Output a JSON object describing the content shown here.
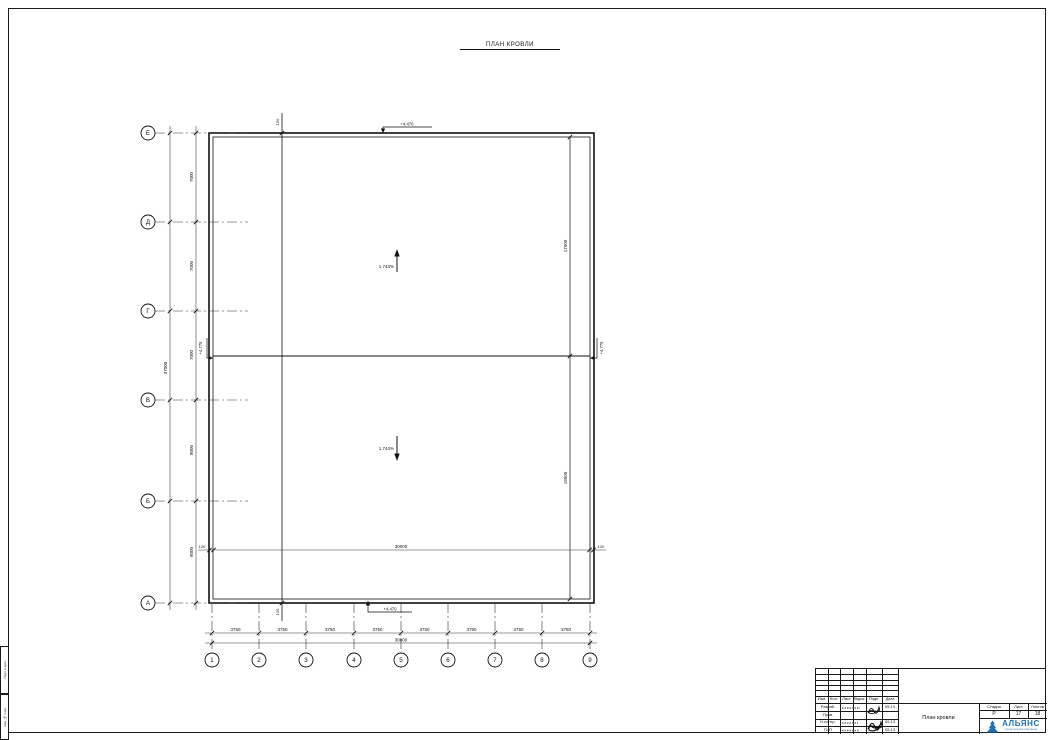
{
  "sheet": {
    "title": "ПЛАН КРОВЛИ"
  },
  "plan": {
    "slopes": {
      "upper": "1.743%",
      "lower": "1.744%"
    },
    "elevations": {
      "top": "+4.470",
      "bottom": "+4.470",
      "ridge_left": "+4.775",
      "ridge_right": "+4.775"
    },
    "axes_rows": {
      "labels": [
        "Е",
        "Д",
        "Г",
        "В",
        "Б",
        "А"
      ],
      "dims": [
        "7000",
        "7000",
        "7000",
        "8000",
        "8000"
      ],
      "total": "37000"
    },
    "axes_cols": {
      "labels": [
        "1",
        "2",
        "3",
        "4",
        "5",
        "6",
        "7",
        "8",
        "9"
      ],
      "dims": [
        "3750",
        "3750",
        "3750",
        "3750",
        "3750",
        "3750",
        "3750",
        "3750"
      ],
      "total": "30000"
    },
    "right_dims": {
      "upper": "17500",
      "lower": "19500"
    },
    "parapet_dims": {
      "top": "120",
      "bottom": "120",
      "inner_left": "120",
      "inner_total": "30000",
      "inner_right": "120"
    }
  },
  "titleblock": {
    "change_header": [
      "Изм.",
      "Кол.",
      "Лист",
      "№док.",
      "Подп.",
      "Дата"
    ],
    "staff": [
      {
        "role": "Разраб.",
        "date": "05.13"
      },
      {
        "role": "Пров.",
        "date": "05.13"
      },
      {
        "role": "Н.контр.",
        "date": "05.13"
      },
      {
        "role": "ГИП",
        "date": "05.13"
      }
    ],
    "stage_label": "Стадия",
    "sheet_label": "Лист",
    "sheets_label": "Листов",
    "stage": "Р",
    "sheet": "17",
    "sheets": "18",
    "doc_title": "План кровли",
    "company": "АЛЬЯНС",
    "company_sub": "строительная компания",
    "logo_color": "#1c72b8"
  },
  "margin_stamps": {
    "upper": "Подп. и дата",
    "lower": "Инв. № подл."
  }
}
